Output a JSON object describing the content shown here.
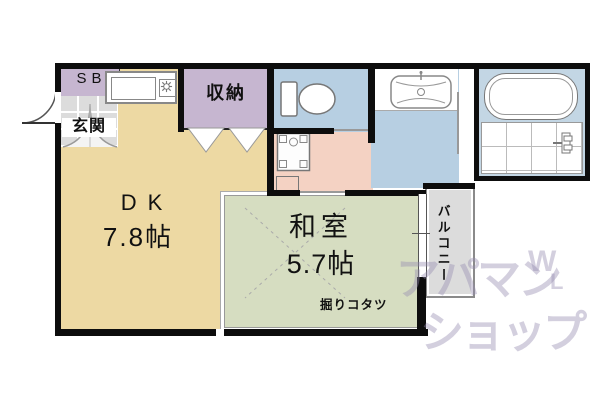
{
  "plan": {
    "sb_label": "SB",
    "genkan_label": "玄関",
    "closet_label": "収納",
    "dk": {
      "name": "DK",
      "size": "7.8帖"
    },
    "washitsu": {
      "name": "和室",
      "size": "5.7帖",
      "feature": "掘りコタツ"
    },
    "balcony_label": "バルコニー"
  },
  "watermark": {
    "line1": "アパマン",
    "line2": "ショップ",
    "mark_top": "W",
    "mark_bottom": "L"
  },
  "colors": {
    "dk": "#edd9a3",
    "washitsu": "#d6ddc1",
    "water_blue": "#b7cfe2",
    "bath_blue": "#c3d6e4",
    "corridor": "#f4d2c3",
    "closet": "#c6b6d0",
    "balcony": "#dcdcdc",
    "wall": "#0d0d0d",
    "watermark": "rgba(150,140,176,0.42)"
  }
}
